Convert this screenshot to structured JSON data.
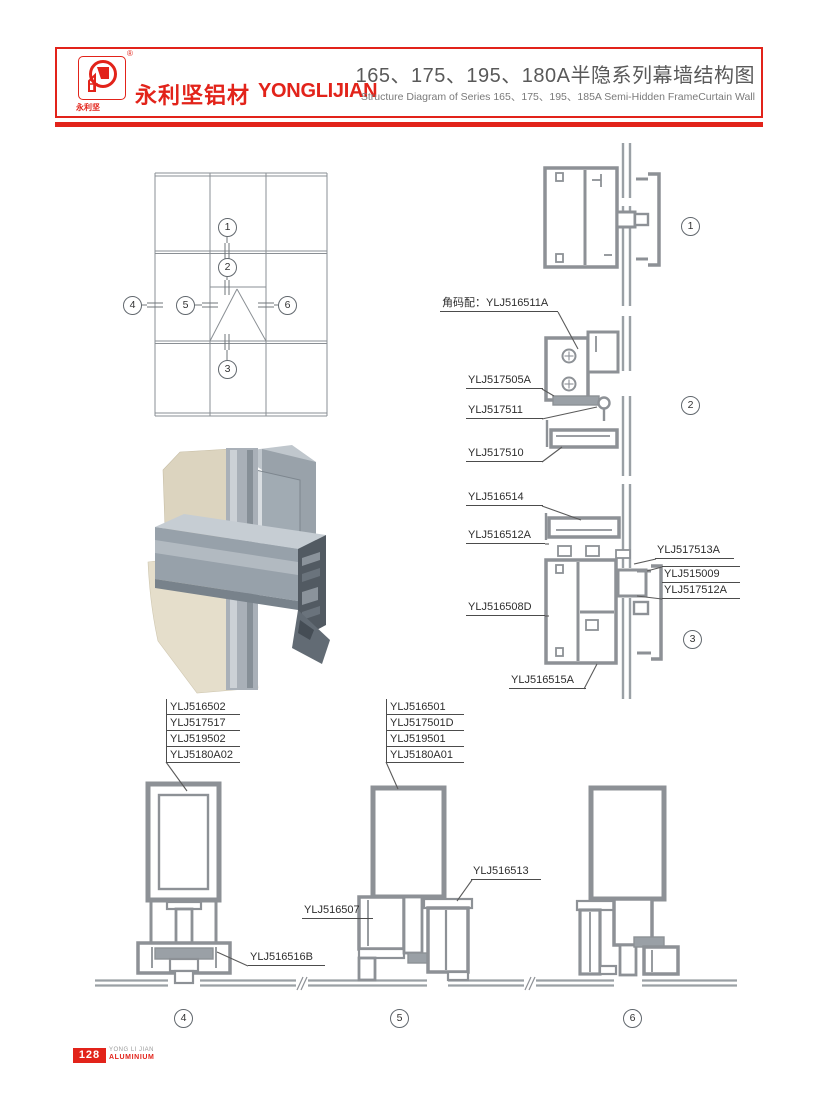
{
  "header": {
    "logo": {
      "registered": "®",
      "sub_text": "永利坚"
    },
    "brand_cn": "永利坚铝材",
    "brand_en": "YONGLIJIAN",
    "title_cn": "165、175、195、180A半隐系列幕墙结构图",
    "title_en": "Structure Diagram of Series 165、175、195、185A Semi-Hidden FrameCurtain Wall"
  },
  "elevation": {
    "callouts": [
      "1",
      "2",
      "3",
      "4",
      "5",
      "6"
    ]
  },
  "sections": {
    "corner_note": "角码配：YLJ516511A",
    "s1": {
      "no": "1"
    },
    "s2": {
      "no": "2",
      "parts": [
        "YLJ517505A",
        "YLJ517511",
        "YLJ517510"
      ]
    },
    "s3": {
      "no": "3",
      "parts_left": [
        "YLJ516514",
        "YLJ516512A",
        "YLJ516508D"
      ],
      "parts_right": [
        "YLJ517513A",
        "YLJ515009",
        "YLJ517512A"
      ],
      "part_bottom": "YLJ516515A"
    },
    "s4": {
      "no": "4",
      "parts": [
        "YLJ516502",
        "YLJ517517",
        "YLJ519502",
        "YLJ5180A02"
      ],
      "part_bottom": "YLJ516516B"
    },
    "s5": {
      "no": "5",
      "parts": [
        "YLJ516501",
        "YLJ517501D",
        "YLJ519501",
        "YLJ5180A01"
      ],
      "part_left": "YLJ516507",
      "part_right": "YLJ516513"
    },
    "s6": {
      "no": "6"
    }
  },
  "footer": {
    "page_number": "128",
    "brand_line1": "YONG LI JIAN",
    "brand_line2": "ALUMINIUM"
  },
  "colors": {
    "accent": "#e2231a",
    "drawing_line": "#8d9196",
    "glass_line": "#9aa0a5",
    "text": "#2e2e2e"
  }
}
